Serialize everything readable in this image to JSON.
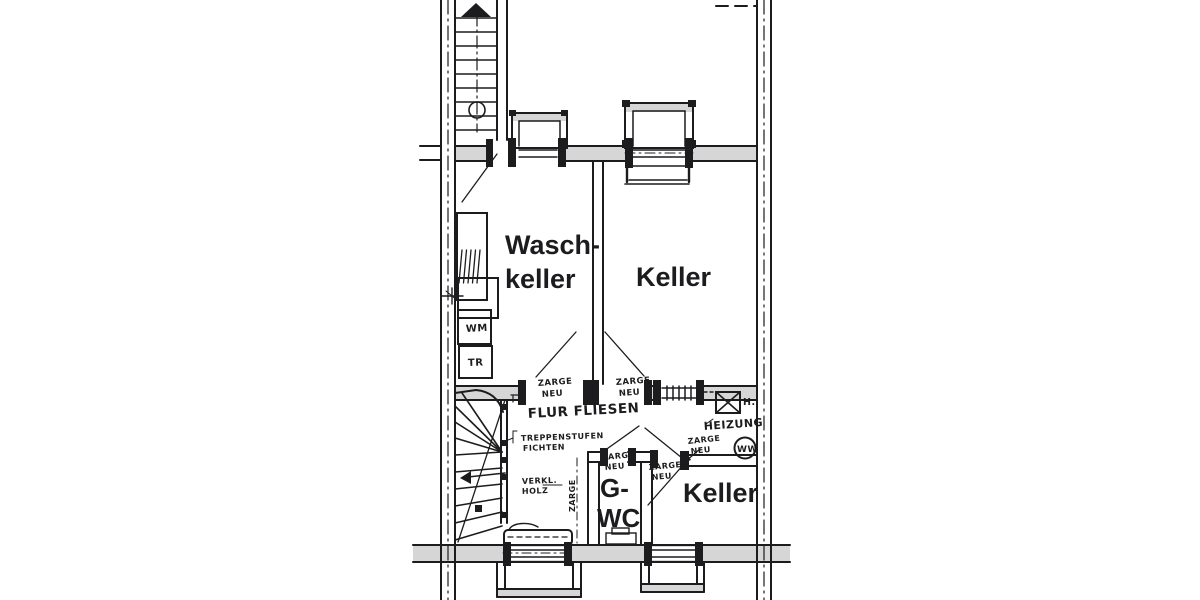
{
  "colors": {
    "background": "#ffffff",
    "ink": "#1c1c1e",
    "wall_fill": "#d6d6d6"
  },
  "rooms": {
    "waschkeller": {
      "line1": "Wasch-",
      "line2": "keller"
    },
    "keller_upper": {
      "label": "Keller"
    },
    "gwc": {
      "line1": "G-",
      "line2": "WC"
    },
    "keller_lower": {
      "label": "Keller"
    }
  },
  "annotations": {
    "zarge_neu": {
      "line1": "ZARGE",
      "line2": "NEU"
    },
    "flur_fliesen": "FLUR FLIESEN",
    "treppenstufen": {
      "line1": "TREPPENSTUFEN",
      "line2": "FICHTEN"
    },
    "verkleidung": {
      "line1": "VERKL.",
      "line2": "HOLZ"
    },
    "heizung": "HEIZUNG",
    "boiler_mark": "H.",
    "warmwasser_mark": "WW",
    "waschmaschine_mark": "WM",
    "trockner_mark": "TR",
    "zarge_vertical": "ZARGE"
  }
}
